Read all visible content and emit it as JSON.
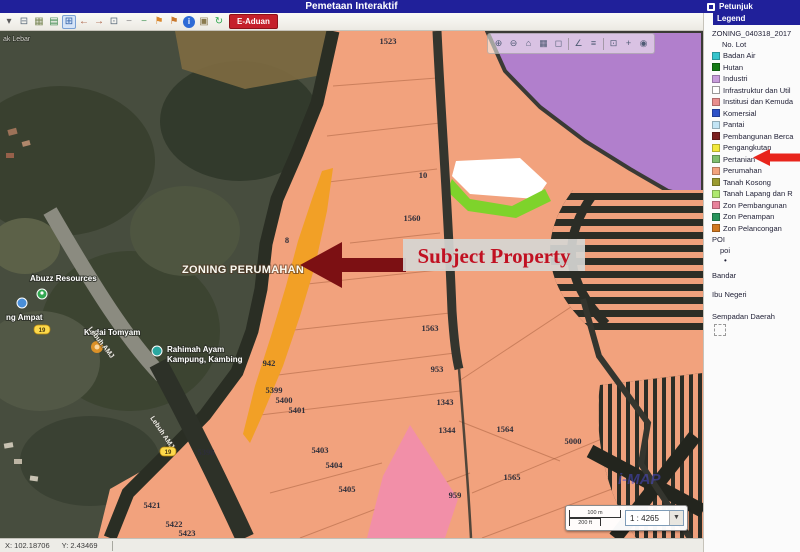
{
  "title_bar": {
    "title": "Pemetaan Interaktif",
    "petunjuk": "Petunjuk"
  },
  "toolbar": {
    "e_aduan": "E-Aduan",
    "icons": [
      {
        "name": "dropdown-caret-icon",
        "glyph": "▾",
        "color": "#5A5A5A"
      },
      {
        "name": "print-icon",
        "glyph": "⊟",
        "color": "#5B6B7C"
      },
      {
        "name": "image-tool-icon",
        "glyph": "▦",
        "color": "#7C8A5A"
      },
      {
        "name": "layers-icon",
        "glyph": "▤",
        "color": "#3E8A4E"
      },
      {
        "name": "zoom-window-icon",
        "glyph": "⊞",
        "color": "#2E5FA8",
        "active": true
      },
      {
        "name": "pan-back-icon",
        "glyph": "←",
        "color": "#A85A3E"
      },
      {
        "name": "pan-forward-icon",
        "glyph": "→",
        "color": "#A85A3E"
      },
      {
        "name": "full-extent-icon",
        "glyph": "⊡",
        "color": "#5A6B7C"
      },
      {
        "name": "prev-extent-icon",
        "glyph": "−",
        "color": "#8A8A8A"
      },
      {
        "name": "next-extent-icon",
        "glyph": "−",
        "color": "#4E9A5E"
      },
      {
        "name": "measure-flag-icon",
        "glyph": "⚑",
        "color": "#D9872B"
      },
      {
        "name": "area-flag-icon",
        "glyph": "⚑",
        "color": "#C9772B"
      },
      {
        "name": "identify-icon",
        "glyph": "i",
        "color": "#FFFFFF",
        "circle": "#2E6BD6"
      },
      {
        "name": "overview-map-icon",
        "glyph": "▣",
        "color": "#8A7A4E"
      },
      {
        "name": "refresh-icon",
        "glyph": "↻",
        "color": "#2FA84F"
      }
    ]
  },
  "map_toolbar": {
    "icons": [
      {
        "name": "zoom-in-map-icon",
        "glyph": "⊕"
      },
      {
        "name": "zoom-out-map-icon",
        "glyph": "⊖"
      },
      {
        "name": "zoom-home-icon",
        "glyph": "⌂"
      },
      {
        "name": "basemap-icon",
        "glyph": "▦"
      },
      {
        "name": "clear-graphics-icon",
        "glyph": "◻"
      },
      {
        "sep": true
      },
      {
        "name": "measure-icon",
        "glyph": "∠"
      },
      {
        "name": "results-icon",
        "glyph": "≡"
      },
      {
        "sep": true
      },
      {
        "name": "select-extent-icon",
        "glyph": "⊡"
      },
      {
        "name": "add-point-icon",
        "glyph": "+"
      },
      {
        "name": "locate-icon",
        "glyph": "◉"
      }
    ]
  },
  "legend": {
    "header": "Legend",
    "layer_title": "ZONING_040318_2017",
    "sublayer": "No. Lot",
    "items": [
      {
        "label": "Badan Air",
        "color": "#35C4CC"
      },
      {
        "label": "Hutan",
        "color": "#157A15"
      },
      {
        "label": "Industri",
        "color": "#C79BDB"
      },
      {
        "label": "Infrastruktur dan Util",
        "color": "#FFFFFF",
        "border": true
      },
      {
        "label": "Institusi dan Kemuda",
        "color": "#E98E8E"
      },
      {
        "label": "Komersial",
        "color": "#2D51C8"
      },
      {
        "label": "Pantai",
        "color": "#C2E4F5"
      },
      {
        "label": "Pembangunan Berca",
        "color": "#7A1F1F"
      },
      {
        "label": "Pengangkutan",
        "color": "#F2E93C"
      },
      {
        "label": "Pertanian",
        "color": "#7FBE6E"
      },
      {
        "label": "Perumahan",
        "color": "#F2A27D",
        "highlighted": true
      },
      {
        "label": "Tanah Kosong",
        "color": "#9A9A30"
      },
      {
        "label": "Tanah Lapang dan R",
        "color": "#AFE96F"
      },
      {
        "label": "Zon Pembangunan",
        "color": "#E8829B"
      },
      {
        "label": "Zon Penampan",
        "color": "#27935B"
      },
      {
        "label": "Zon Pelancongan",
        "color": "#D07820"
      }
    ],
    "poi_title": "POI",
    "poi_sub": "poi",
    "poi_dot": "•",
    "bandar": "Bandar",
    "ibu_negeri": "Ibu Negeri",
    "sempadan": "Sempadan Daerah",
    "arrow_color": "#E8251C"
  },
  "map": {
    "zoning_label": {
      "text": "ZONING PERUMAHAN",
      "x": 182,
      "y": 242
    },
    "annotation": "Subject Property",
    "annotation_color": "#C11122",
    "arrow_color": "#7C1013",
    "corner_label": {
      "text": "ak Lebar",
      "x": 3,
      "y": 10
    },
    "watermark": {
      "text": "i-MAP",
      "x": 618,
      "y": 453
    },
    "parcels": [
      {
        "id": "1523",
        "x": 388,
        "y": 13
      },
      {
        "id": "10",
        "x": 423,
        "y": 147
      },
      {
        "id": "1560",
        "x": 412,
        "y": 190
      },
      {
        "id": "8",
        "x": 287,
        "y": 212
      },
      {
        "id": "1563",
        "x": 430,
        "y": 300
      },
      {
        "id": "953",
        "x": 437,
        "y": 341
      },
      {
        "id": "1343",
        "x": 445,
        "y": 374
      },
      {
        "id": "1344",
        "x": 447,
        "y": 402
      },
      {
        "id": "1564",
        "x": 505,
        "y": 401
      },
      {
        "id": "5000",
        "x": 573,
        "y": 413
      },
      {
        "id": "1565",
        "x": 512,
        "y": 449
      },
      {
        "id": "959",
        "x": 455,
        "y": 467
      },
      {
        "id": "942",
        "x": 269,
        "y": 335
      },
      {
        "id": "5399",
        "x": 274,
        "y": 362
      },
      {
        "id": "5400",
        "x": 284,
        "y": 372
      },
      {
        "id": "5401",
        "x": 297,
        "y": 382
      },
      {
        "id": "5398",
        "x": 206,
        "y": 424
      },
      {
        "id": "5403",
        "x": 320,
        "y": 422
      },
      {
        "id": "5404",
        "x": 334,
        "y": 437
      },
      {
        "id": "5405",
        "x": 347,
        "y": 461
      },
      {
        "id": "5421",
        "x": 152,
        "y": 477
      },
      {
        "id": "5422",
        "x": 174,
        "y": 496
      },
      {
        "id": "5423",
        "x": 187,
        "y": 505
      }
    ],
    "pois": [
      {
        "label": "Abuzz Resources",
        "x": 30,
        "y": 250
      },
      {
        "label": "ng Ampat",
        "x": 6,
        "y": 289
      },
      {
        "label": "Kedai Tomyam",
        "x": 84,
        "y": 304
      },
      {
        "label": "Rahimah Ayam",
        "label2": "Kampung, Kambing",
        "x": 167,
        "y": 321
      }
    ],
    "road_labels": [
      {
        "label": "Lebuh AMJ",
        "x": 88,
        "y": 298,
        "angle": 52
      },
      {
        "label": "Lebuh AMJ",
        "x": 150,
        "y": 387,
        "angle": 56
      }
    ],
    "shields": [
      {
        "label": "19",
        "x": 42,
        "y": 299
      },
      {
        "label": "19",
        "x": 168,
        "y": 421
      }
    ],
    "zone_colors": {
      "perumahan": "#F2A27D",
      "orange_lot": "#F2A026",
      "pink_lot": "#F28FA8",
      "industri": "#B17FCC",
      "green_lot": "#7ED32B"
    }
  },
  "scale_widget": {
    "bar_top": "100 m",
    "bar_bottom": "200 ft",
    "ratio": "1 : 4265"
  },
  "status_bar": {
    "x_label": "X: 102.18706",
    "y_label": "Y: 2.43469"
  }
}
